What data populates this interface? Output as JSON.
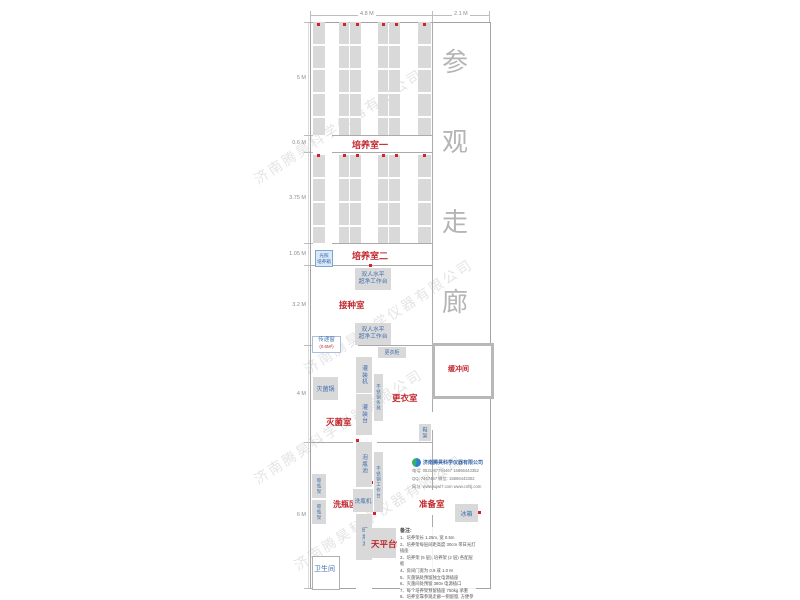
{
  "watermark": "济南腾昊科学仪器有限公司",
  "dimensions": {
    "top": [
      "4.8 M",
      "2.1 M"
    ],
    "left": [
      "5 M",
      "0.6 M",
      "3.75 M",
      "1.05 M",
      "3.2 M",
      "4 M",
      "6 M"
    ]
  },
  "corridor": {
    "label": "参观走廊",
    "chars": [
      "参",
      "观",
      "走",
      "廊"
    ]
  },
  "rooms": {
    "culture1": "培养室一",
    "culture2": "培养室二",
    "inoculation": "接种室",
    "sterilization": "灭菌室",
    "changing": "更衣室",
    "buffer": "缓冲间",
    "washing": "洗瓶区",
    "preparation": "准备室",
    "balance": "天平台",
    "toilet": "卫生间"
  },
  "equipment": {
    "incubator_line1": "光照",
    "incubator_line2": "培养箱",
    "bench_line1": "双人水平",
    "bench_line2": "超净工作台",
    "pass_window": "传递窗",
    "pass_window_size": "(0.6M²)",
    "autoclave": "灭菌锅",
    "filler": "灌装机",
    "filling_table": "灌装台",
    "ss_bench": "不锈钢条凳",
    "wardrobe": "更衣柜",
    "shoe_rack": "鞋架",
    "soak_pool": "泡瓶池",
    "ss_worktable": "不锈钢工作台",
    "dry_rack": "晾瓶架",
    "washer": "洗瓶机",
    "dry_pool": "晾瓶池",
    "fridge": "冰箱"
  },
  "notes": {
    "header": "备注:",
    "items": [
      "1、培养架长 1.25m, 宽 0.5m",
      "2、培养架每层间距高度 30cm 带日光灯插座",
      "3、培养架 (5 层), 培养架 (2 层) 各配层板",
      "4、房间门宽为 0.9 或 1.0 M",
      "5、灭菌锅处预留独立电源插座",
      "6、灭菌间处预留 380v 电源插口",
      "7、每个培养架预留插座 750kg 承重",
      "8、培养室靠参观走廊一侧留窗, 方便参观学习。"
    ]
  },
  "company": {
    "name": "济南腾昊科学仪器有限公司",
    "phone": "电话: 0531-87794467  15866443352",
    "qq": "QQ: 7457467  微信: 15866443352",
    "web": "网址: www.sqwl7.com  www.cnhlj.com"
  }
}
